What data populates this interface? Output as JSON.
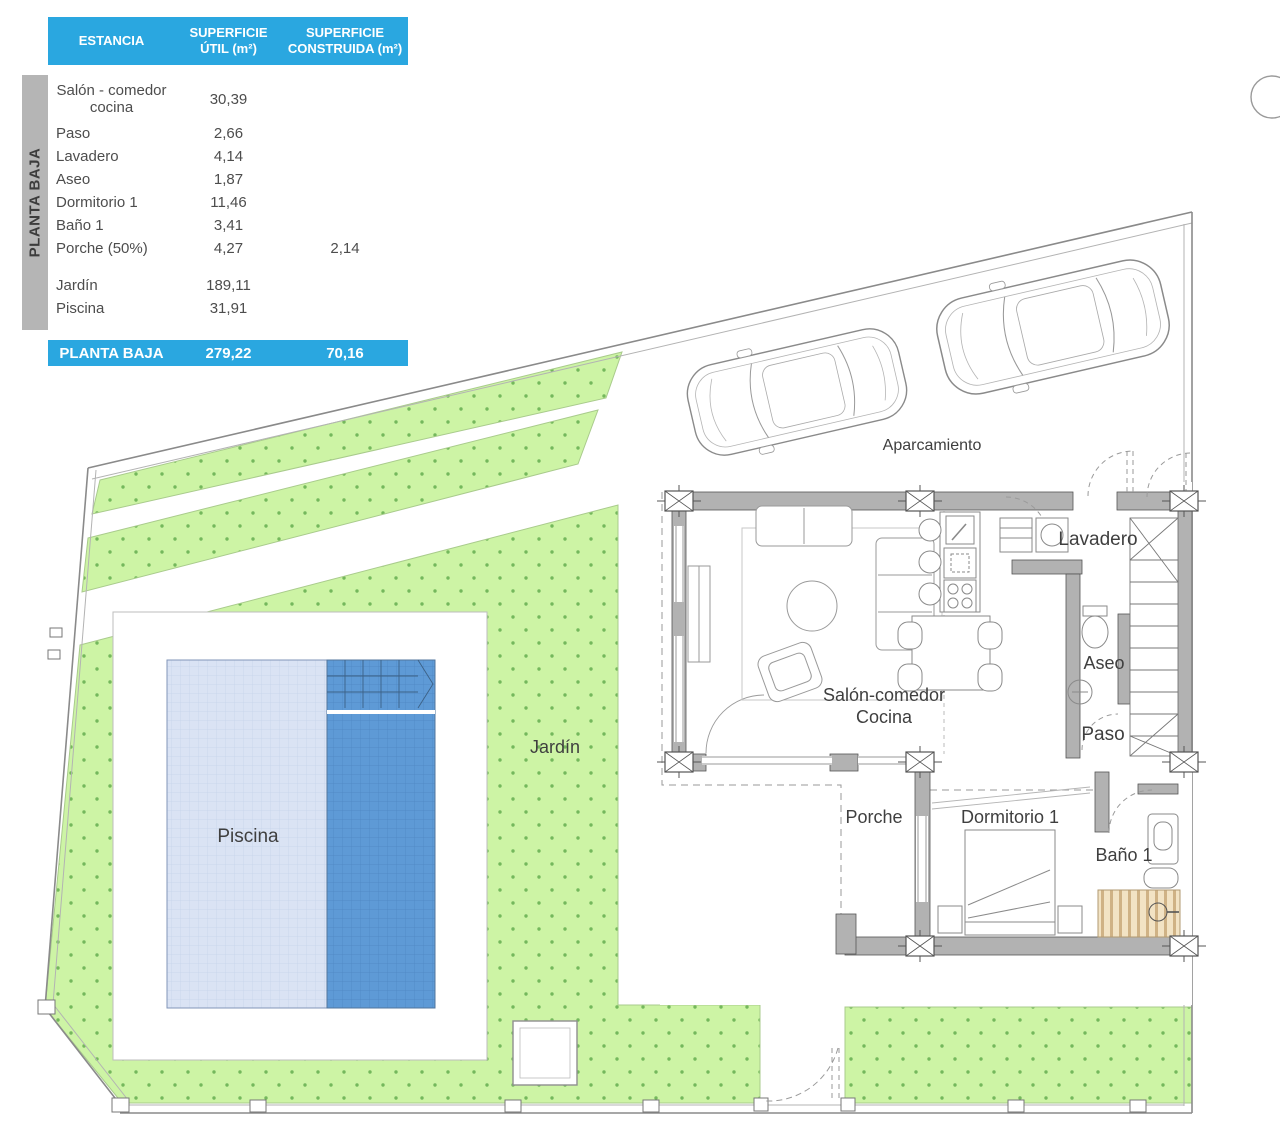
{
  "side_label": "PLANTA BAJA",
  "table": {
    "header": {
      "col1": "ESTANCIA",
      "col2_l1": "SUPERFICIE",
      "col2_l2": "ÚTIL (m²)",
      "col3_l1": "SUPERFICIE",
      "col3_l2": "CONSTRUIDA (m²)"
    },
    "rows": [
      {
        "name": "Salón - comedor cocina",
        "util": "30,39",
        "built": ""
      },
      {
        "name": "Paso",
        "util": "2,66",
        "built": ""
      },
      {
        "name": "Lavadero",
        "util": "4,14",
        "built": ""
      },
      {
        "name": "Aseo",
        "util": "1,87",
        "built": ""
      },
      {
        "name": "Dormitorio 1",
        "util": "11,46",
        "built": ""
      },
      {
        "name": "Baño 1",
        "util": "3,41",
        "built": ""
      },
      {
        "name": "Porche (50%)",
        "util": "4,27",
        "built": "2,14"
      },
      {
        "name": "Jardín",
        "util": "189,11",
        "built": ""
      },
      {
        "name": "Piscina",
        "util": "31,91",
        "built": ""
      }
    ],
    "total": {
      "label": "PLANTA BAJA",
      "util": "279,22",
      "built": "70,16"
    }
  },
  "plan": {
    "labels": {
      "aparcamiento": "Aparcamiento",
      "lavadero": "Lavadero",
      "aseo": "Aseo",
      "paso": "Paso",
      "salon_l1": "Salón-comedor",
      "salon_l2": "Cocina",
      "porche": "Porche",
      "dormitorio": "Dormitorio 1",
      "bano": "Baño 1",
      "jardin": "Jardín",
      "piscina": "Piscina"
    },
    "colors": {
      "accent_blue": "#2aa7e0",
      "garden": "#cdf4a5",
      "garden_dot": "#74b85c",
      "pool_light": "#dae3f4",
      "pool_dark": "#5e9ad6",
      "wall": "#b2b2b2",
      "shower": "#f2e3c4",
      "label_text": "#3f3f3f"
    }
  }
}
